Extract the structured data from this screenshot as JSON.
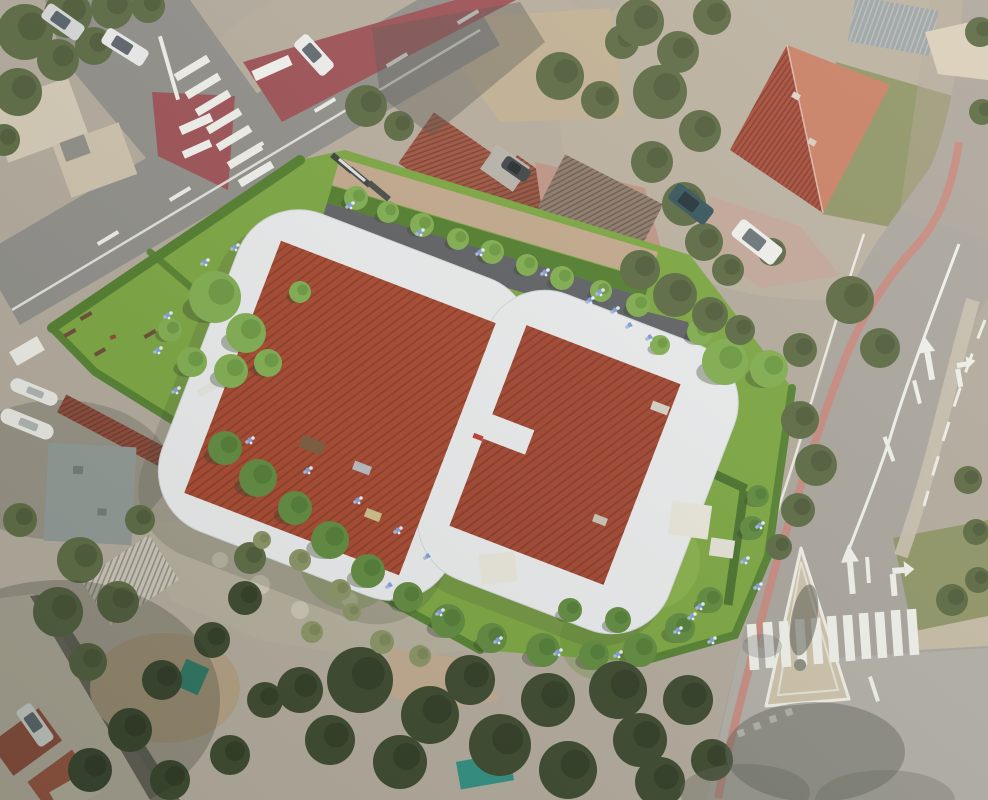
{
  "colors": {
    "bg": "#b3ab9d",
    "roadN": "#8f8e8a",
    "roadE": "#a9a59e",
    "redZone": "#9d4f55",
    "pinkWalk": "#c9877c",
    "marking": "#f2f3ee",
    "island": "#cfc3ac",
    "grassPhoto": "#8e9566",
    "scrub": "#b5af9d",
    "dirt": "#c2b194",
    "gravel": "#c2a98c",
    "lawn": "#7aa73f",
    "hedge": "#4f7d2b",
    "hedgeDark": "#46702a",
    "drive": "#5c5f63",
    "terrace": "#eceef0",
    "roofNew": "#a7452d",
    "roofNew2": "#a2432e",
    "roofOld": "#a0523f",
    "bigRoofA": "#a84a38",
    "bigRoofB": "#c97f64",
    "corrRed": "#8a4636",
    "concreteNE": "#c2a79a",
    "shedGray": "#9ba3a4",
    "flatRoof": "#8f9995",
    "paleRoof": "#d6cbb8",
    "shadow": "#3c4136"
  },
  "scene": {
    "tree_styles": {
      "bright": {
        "group": "g-site-trees",
        "fill": "#7fae4e",
        "spot": "#598a34",
        "shadow": "#2e3a22"
      },
      "mid": {
        "group": "g-site-trees",
        "fill": "#5d8a3c",
        "spot": "#44702a",
        "shadow": "#2e3a22"
      },
      "photo": {
        "group": "g-photo-trees",
        "fill": "#5a6942",
        "spot": "#424f30",
        "shadow": ""
      },
      "dark": {
        "group": "g-photo-trees",
        "fill": "#39472c",
        "spot": "#26301d",
        "shadow": ""
      },
      "scrub": {
        "group": "g-photo-trees",
        "fill": "#8a9464",
        "spot": "#6d7a4c",
        "shadow": ""
      }
    },
    "trees": {
      "bright": [
        [
          215,
          297,
          26
        ],
        [
          246,
          333,
          20
        ],
        [
          192,
          362,
          15
        ],
        [
          268,
          363,
          14
        ],
        [
          170,
          330,
          12
        ],
        [
          231,
          371,
          17
        ],
        [
          300,
          292,
          11
        ],
        [
          356,
          198,
          12
        ],
        [
          388,
          212,
          11
        ],
        [
          422,
          225,
          12
        ],
        [
          458,
          239,
          11
        ],
        [
          492,
          252,
          12
        ],
        [
          527,
          265,
          11
        ],
        [
          562,
          278,
          12
        ],
        [
          601,
          291,
          11
        ],
        [
          638,
          305,
          12
        ],
        [
          725,
          362,
          23
        ],
        [
          769,
          369,
          19
        ],
        [
          700,
          332,
          13
        ],
        [
          660,
          345,
          10
        ]
      ],
      "mid": [
        [
          225,
          448,
          17
        ],
        [
          258,
          478,
          19
        ],
        [
          295,
          508,
          17
        ],
        [
          330,
          540,
          19
        ],
        [
          368,
          571,
          17
        ],
        [
          408,
          597,
          15
        ],
        [
          448,
          621,
          17
        ],
        [
          492,
          638,
          15
        ],
        [
          543,
          650,
          17
        ],
        [
          594,
          655,
          15
        ],
        [
          640,
          650,
          17
        ],
        [
          680,
          628,
          15
        ],
        [
          710,
          600,
          13
        ],
        [
          752,
          528,
          12
        ],
        [
          758,
          496,
          11
        ],
        [
          618,
          620,
          13
        ],
        [
          570,
          610,
          12
        ]
      ],
      "photo": [
        [
          25,
          32,
          28
        ],
        [
          68,
          14,
          24
        ],
        [
          112,
          8,
          21
        ],
        [
          18,
          92,
          24
        ],
        [
          58,
          60,
          21
        ],
        [
          148,
          6,
          17
        ],
        [
          94,
          46,
          19
        ],
        [
          4,
          140,
          16
        ],
        [
          366,
          106,
          21
        ],
        [
          399,
          126,
          15
        ],
        [
          560,
          76,
          24
        ],
        [
          600,
          100,
          19
        ],
        [
          622,
          42,
          17
        ],
        [
          652,
          162,
          21
        ],
        [
          684,
          204,
          22
        ],
        [
          704,
          242,
          19
        ],
        [
          728,
          270,
          16
        ],
        [
          640,
          22,
          24
        ],
        [
          678,
          52,
          21
        ],
        [
          712,
          16,
          19
        ],
        [
          660,
          92,
          27
        ],
        [
          700,
          131,
          21
        ],
        [
          850,
          300,
          24
        ],
        [
          880,
          348,
          20
        ],
        [
          800,
          350,
          17
        ],
        [
          772,
          252,
          14
        ],
        [
          980,
          32,
          15
        ],
        [
          982,
          112,
          13
        ],
        [
          640,
          270,
          20
        ],
        [
          675,
          295,
          22
        ],
        [
          710,
          315,
          18
        ],
        [
          740,
          330,
          15
        ],
        [
          800,
          420,
          19
        ],
        [
          816,
          465,
          21
        ],
        [
          798,
          510,
          17
        ],
        [
          779,
          547,
          13
        ],
        [
          968,
          480,
          14
        ],
        [
          976,
          532,
          13
        ],
        [
          952,
          600,
          16
        ],
        [
          978,
          580,
          13
        ],
        [
          80,
          560,
          23
        ],
        [
          58,
          612,
          25
        ],
        [
          118,
          602,
          21
        ],
        [
          88,
          662,
          19
        ],
        [
          20,
          520,
          17
        ],
        [
          140,
          520,
          15
        ],
        [
          250,
          558,
          16
        ]
      ],
      "dark": [
        [
          360,
          680,
          33
        ],
        [
          430,
          715,
          29
        ],
        [
          500,
          745,
          31
        ],
        [
          568,
          770,
          29
        ],
        [
          640,
          740,
          27
        ],
        [
          688,
          700,
          25
        ],
        [
          618,
          690,
          29
        ],
        [
          548,
          700,
          27
        ],
        [
          470,
          680,
          25
        ],
        [
          400,
          762,
          27
        ],
        [
          330,
          740,
          25
        ],
        [
          300,
          690,
          23
        ],
        [
          660,
          782,
          25
        ],
        [
          712,
          760,
          21
        ],
        [
          245,
          598,
          17
        ],
        [
          212,
          640,
          18
        ],
        [
          162,
          680,
          20
        ],
        [
          130,
          730,
          22
        ],
        [
          90,
          770,
          22
        ],
        [
          230,
          755,
          20
        ],
        [
          170,
          780,
          20
        ],
        [
          265,
          700,
          18
        ]
      ],
      "scrub": [
        [
          300,
          560,
          11
        ],
        [
          340,
          590,
          11
        ],
        [
          262,
          540,
          9
        ],
        [
          382,
          642,
          12
        ],
        [
          420,
          656,
          11
        ],
        [
          312,
          632,
          11
        ],
        [
          352,
          612,
          9
        ]
      ]
    },
    "flower_colors": [
      "#7f9fd8",
      "#eef2f8",
      "#a9bce4"
    ],
    "flowers": [
      [
        350,
        205
      ],
      [
        420,
        232
      ],
      [
        480,
        252
      ],
      [
        545,
        272
      ],
      [
        600,
        292
      ],
      [
        630,
        325
      ],
      [
        650,
        337
      ],
      [
        168,
        315
      ],
      [
        158,
        350
      ],
      [
        176,
        390
      ],
      [
        205,
        262
      ],
      [
        235,
        247
      ],
      [
        390,
        585
      ],
      [
        440,
        612
      ],
      [
        498,
        640
      ],
      [
        558,
        652
      ],
      [
        618,
        654
      ],
      [
        678,
        630
      ],
      [
        700,
        606
      ],
      [
        745,
        560
      ],
      [
        758,
        586
      ],
      [
        692,
        616
      ],
      [
        712,
        640
      ],
      [
        250,
        440
      ],
      [
        308,
        470
      ],
      [
        358,
        500
      ],
      [
        398,
        530
      ],
      [
        428,
        556
      ],
      [
        590,
        300
      ],
      [
        615,
        310
      ],
      [
        760,
        525
      ]
    ],
    "rects": {
      "g-markings": [
        [
          192,
          68,
          38,
          8,
          -31,
          "#f2f3ee",
          "zebra-stripe"
        ],
        [
          203,
          86,
          38,
          8,
          -31,
          "#f2f3ee",
          "zebra-stripe"
        ],
        [
          213,
          103,
          38,
          8,
          -31,
          "#f2f3ee",
          "zebra-stripe"
        ],
        [
          224,
          121,
          38,
          8,
          -31,
          "#f2f3ee",
          "zebra-stripe"
        ],
        [
          234,
          138,
          38,
          8,
          -31,
          "#f2f3ee",
          "zebra-stripe"
        ],
        [
          245,
          156,
          38,
          8,
          -31,
          "#f2f3ee",
          "zebra-stripe"
        ],
        [
          256,
          174,
          38,
          8,
          -31,
          "#f2f3ee",
          "zebra-stripe"
        ],
        [
          266,
          191,
          38,
          8,
          -31,
          "#f2f3ee",
          "zebra-stripe"
        ],
        [
          753,
          647,
          9.5,
          46,
          -4,
          "#f2f3ee",
          "zebra-stripe"
        ],
        [
          769,
          645,
          9.5,
          46,
          -4,
          "#f2f3ee",
          "zebra-stripe"
        ],
        [
          785,
          644,
          9.5,
          46,
          -4,
          "#f2f3ee",
          "zebra-stripe"
        ],
        [
          801,
          642,
          9.5,
          46,
          -4,
          "#f2f3ee",
          "zebra-stripe"
        ],
        [
          817,
          641,
          9.5,
          46,
          -4,
          "#f2f3ee",
          "zebra-stripe"
        ],
        [
          833,
          639,
          9.5,
          46,
          -4,
          "#f2f3ee",
          "zebra-stripe"
        ],
        [
          849,
          638,
          9.5,
          46,
          -4,
          "#f2f3ee",
          "zebra-stripe"
        ],
        [
          865,
          636,
          9.5,
          46,
          -4,
          "#f2f3ee",
          "zebra-stripe"
        ],
        [
          881,
          635,
          9.5,
          46,
          -4,
          "#f2f3ee",
          "zebra-stripe"
        ],
        [
          897,
          633,
          9.5,
          46,
          -4,
          "#f2f3ee",
          "zebra-stripe"
        ],
        [
          913,
          632,
          9.5,
          46,
          -4,
          "#f2f3ee",
          "zebra-stripe"
        ],
        [
          108,
          238,
          24,
          4,
          -31,
          "#f0f1ec",
          "lane-dash"
        ],
        [
          180,
          194,
          24,
          4,
          -31,
          "#f0f1ec",
          "lane-dash"
        ],
        [
          253,
          149,
          24,
          4,
          -31,
          "#f0f1ec",
          "lane-dash"
        ],
        [
          325,
          105,
          24,
          4,
          -31,
          "#f0f1ec",
          "lane-dash"
        ],
        [
          397,
          60,
          24,
          4,
          -31,
          "#f0f1ec",
          "lane-dash"
        ],
        [
          468,
          17,
          24,
          4,
          -31,
          "#f0f1ec",
          "lane-dash"
        ],
        [
          917,
          392,
          4,
          24,
          -14,
          "#f2f3ee",
          "lane-dash"
        ],
        [
          889,
          449,
          4,
          26,
          -20,
          "#f2f3ee",
          "lane-dash"
        ],
        [
          874,
          689,
          4,
          26,
          -18,
          "#f2f3ee",
          "lane-dash"
        ],
        [
          868,
          570,
          4,
          26,
          -4,
          "#f2f3ee",
          "lane-dash"
        ],
        [
          169,
          68,
          4,
          66,
          -16,
          "#f2f3ee",
          "edge-line"
        ],
        [
          272,
          68,
          40,
          11,
          -24,
          "#f4f4f2",
          "pavement-bar"
        ],
        [
          196,
          124,
          34,
          9,
          -24,
          "#f4f4f2",
          "pavement-bar"
        ],
        [
          197,
          149,
          30,
          8,
          -24,
          "#f4f4f2",
          "pavement-bar"
        ],
        [
          741,
          733,
          7,
          7,
          -20,
          "#f2f3ee",
          "yield-dash"
        ],
        [
          757,
          726,
          7,
          7,
          -20,
          "#f2f3ee",
          "yield-dash"
        ],
        [
          773,
          719,
          7,
          7,
          -20,
          "#f2f3ee",
          "yield-dash"
        ],
        [
          789,
          712,
          7,
          7,
          -20,
          "#f2f3ee",
          "yield-dash"
        ]
      ],
      "g-props": [
        [
          86,
          316,
          13,
          4,
          -30,
          "#6b4a33",
          "bench"
        ],
        [
          70,
          333,
          13,
          4,
          -30,
          "#6b4a33",
          "bench"
        ],
        [
          150,
          334,
          13,
          4,
          -30,
          "#6b4a33",
          "bench"
        ],
        [
          100,
          352,
          12,
          4,
          -30,
          "#6b4a33",
          "bench"
        ],
        [
          113,
          337,
          6,
          4,
          -20,
          "#8a4a2f",
          "dog"
        ],
        [
          342,
          163,
          26,
          6,
          40,
          "#3a3f3a",
          "fence-panel"
        ],
        [
          360,
          177,
          26,
          6,
          40,
          "#3a3f3a",
          "fence-panel"
        ],
        [
          379,
          191,
          26,
          6,
          40,
          "#454a45",
          "fence-panel"
        ],
        [
          352,
          170,
          34,
          3,
          40,
          "#dfe3e4",
          "fence-rail"
        ],
        [
          27,
          351,
          32,
          16,
          -30,
          "#efefe9",
          "sign-board"
        ],
        [
          207,
          389,
          20,
          8,
          -30,
          "#e8e8e4",
          "steps"
        ],
        [
          312,
          445,
          24,
          13,
          21,
          "#7a5a3a",
          "table-set"
        ],
        [
          362,
          468,
          18,
          9,
          21,
          "#b9bcc0",
          "lounger"
        ],
        [
          373,
          515,
          16,
          9,
          21,
          "#cfc08a",
          "lounger"
        ],
        [
          660,
          408,
          18,
          9,
          21,
          "#d8d3c8",
          "table-set"
        ],
        [
          600,
          520,
          14,
          8,
          21,
          "#c9c4b8",
          "lounger"
        ],
        [
          478,
          437,
          10,
          5,
          21,
          "#c0392b",
          "rooftop-hatch"
        ],
        [
          498,
          568,
          36,
          30,
          -6,
          "#ebe9de",
          "pergola"
        ],
        [
          690,
          520,
          40,
          34,
          8,
          "#ebe9de",
          "pergola"
        ],
        [
          722,
          548,
          24,
          18,
          8,
          "#e6e4d8",
          "garden-table"
        ],
        [
          485,
          771,
          54,
          28,
          -10,
          "#2f8f83",
          "pool-table"
        ],
        [
          192,
          677,
          25,
          29,
          24,
          "#2c8a74",
          "tent"
        ],
        [
          78,
          470,
          10,
          8,
          3,
          "#6f7a76",
          "roof-vent"
        ],
        [
          102,
          512,
          9,
          7,
          3,
          "#6f7a76",
          "roof-vent"
        ],
        [
          796,
          96,
          8,
          6,
          30,
          "#e0d6c8",
          "chimney"
        ],
        [
          812,
          142,
          8,
          6,
          30,
          "#d8cec0",
          "chimney"
        ]
      ]
    },
    "cars": [
      [
        63,
        22,
        44,
        18,
        35,
        "#d8dadb",
        "#55606a"
      ],
      [
        125,
        47,
        48,
        18,
        32,
        "#eceeee",
        "#5a646c"
      ],
      [
        314,
        55,
        44,
        18,
        48,
        "#f1f2f1",
        "#5f6870"
      ],
      [
        691,
        204,
        46,
        20,
        38,
        "#31535c",
        "#1e3138"
      ],
      [
        757,
        242,
        52,
        21,
        38,
        "#f0f1ef",
        "#6a7378"
      ],
      [
        35,
        725,
        44,
        18,
        55,
        "#eef0ee",
        "#667078"
      ],
      [
        516,
        169,
        30,
        14,
        35,
        "#3c4246",
        "#22282c"
      ]
    ],
    "boats": [
      [
        34,
        392,
        50,
        14,
        22
      ],
      [
        27,
        424,
        56,
        16,
        22
      ]
    ]
  }
}
